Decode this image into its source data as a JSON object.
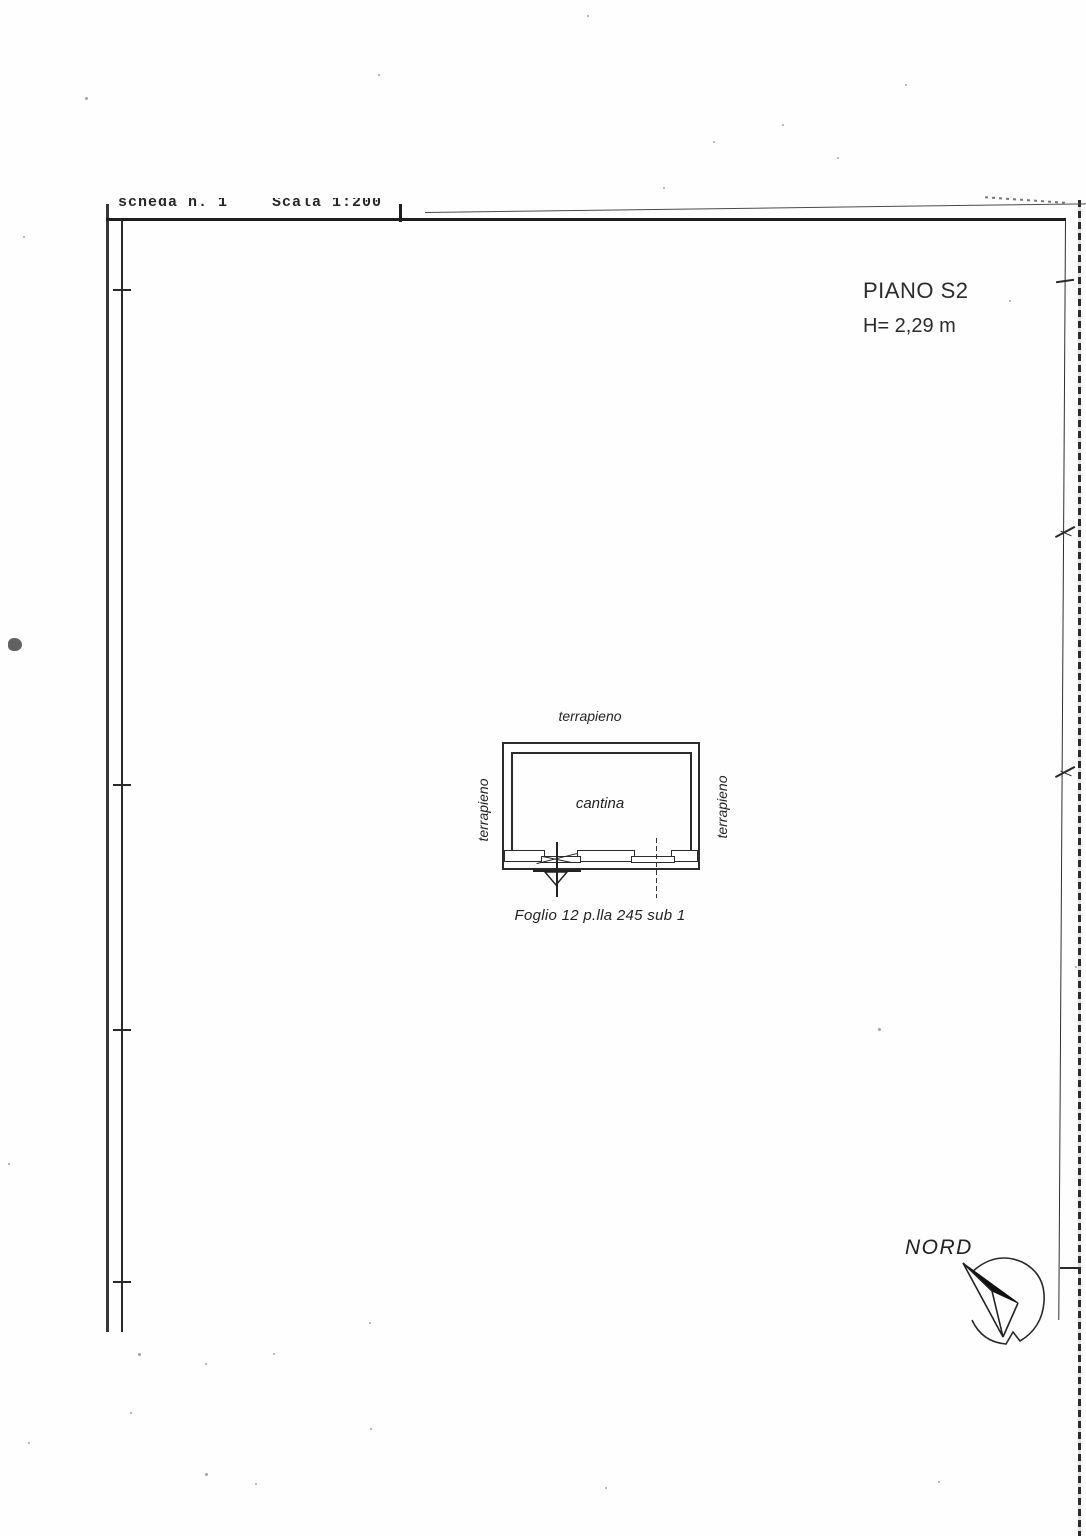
{
  "document": {
    "header": {
      "sheet_number": "scheda n. 1",
      "scale": "Scala 1:200"
    },
    "floor": {
      "name": "PIANO S2",
      "height": "H= 2,29 m"
    },
    "plan": {
      "room": "cantina",
      "surround_top": "terrapieno",
      "surround_left": "terrapieno",
      "surround_right": "terrapieno",
      "cadastral_ref": "Foglio 12 p.lla 245 sub 1"
    },
    "compass": {
      "label": "NORD"
    }
  },
  "colors": {
    "ink": "#222222",
    "paper": "#fefefe"
  }
}
